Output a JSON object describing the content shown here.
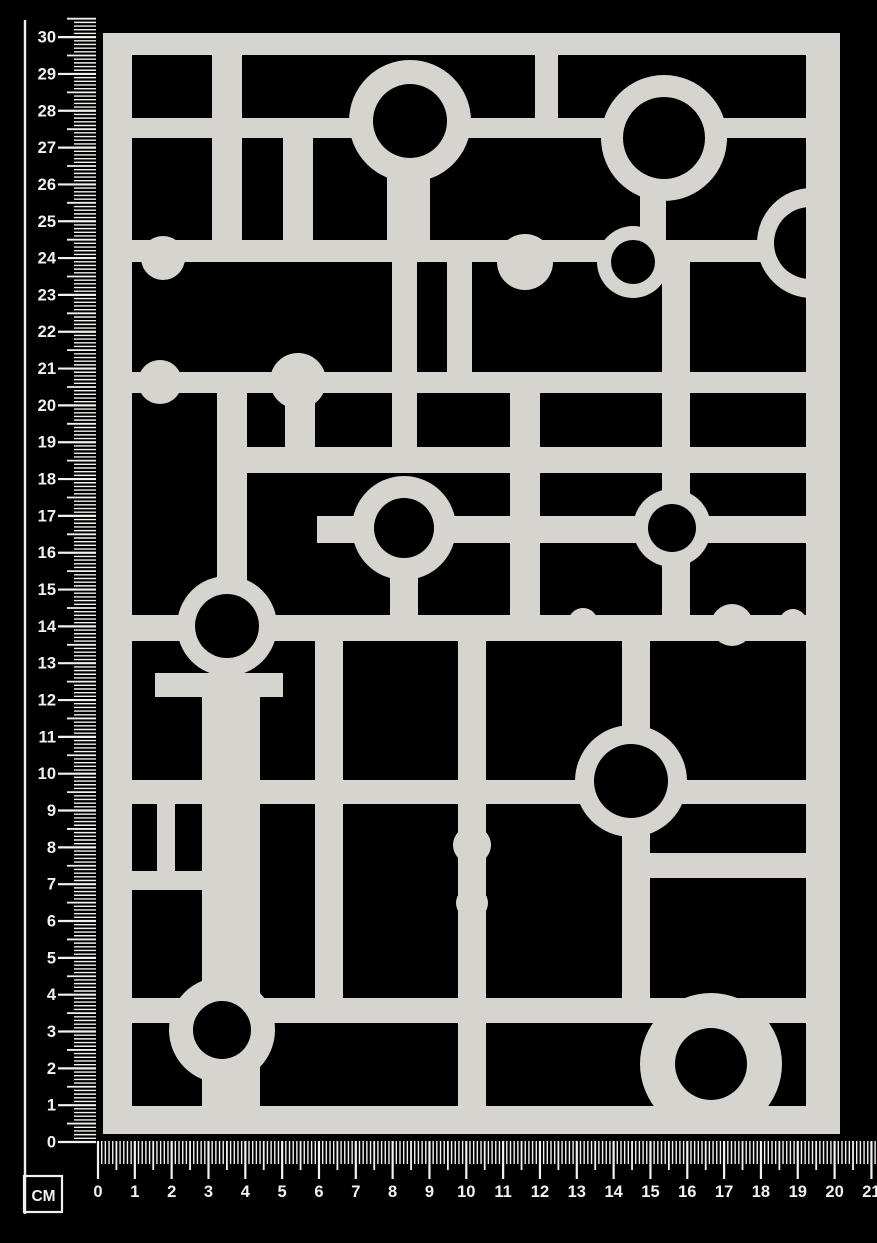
{
  "colors": {
    "background": "#000000",
    "board": "#d6d4cf",
    "cutout": "#000000",
    "ruler": "#f2f1ee"
  },
  "rulers": {
    "unit_label": "CM",
    "vertical": {
      "numbers": [
        0,
        1,
        2,
        3,
        4,
        5,
        6,
        7,
        8,
        9,
        10,
        11,
        12,
        13,
        14,
        15,
        16,
        17,
        18,
        19,
        20,
        21,
        22,
        23,
        24,
        25,
        26,
        27,
        28,
        29,
        30
      ]
    },
    "horizontal": {
      "numbers": [
        0,
        1,
        2,
        3,
        4,
        5,
        6,
        7,
        8,
        9,
        10,
        11,
        12,
        13,
        14,
        15,
        16,
        17,
        18,
        19,
        20,
        21
      ]
    }
  }
}
